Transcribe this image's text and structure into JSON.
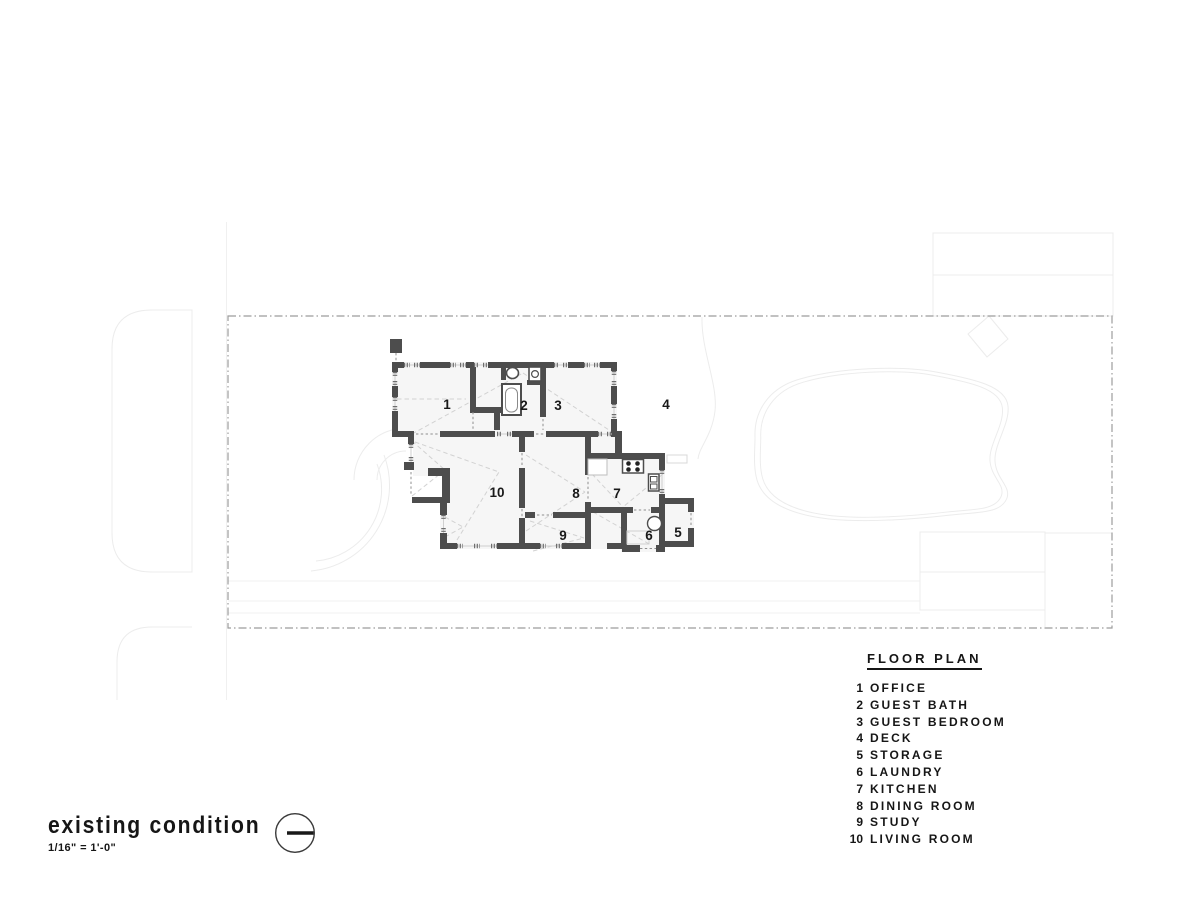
{
  "title_block": {
    "title": "existing condition",
    "scale": "1/16\" = 1'-0\""
  },
  "legend": {
    "title": "FLOOR PLAN",
    "items": [
      {
        "num": "1",
        "label": "OFFICE"
      },
      {
        "num": "2",
        "label": "GUEST BATH"
      },
      {
        "num": "3",
        "label": "GUEST BEDROOM"
      },
      {
        "num": "4",
        "label": "DECK"
      },
      {
        "num": "5",
        "label": "STORAGE"
      },
      {
        "num": "6",
        "label": "LAUNDRY"
      },
      {
        "num": "7",
        "label": "KITCHEN"
      },
      {
        "num": "8",
        "label": "DINING ROOM"
      },
      {
        "num": "9",
        "label": "STUDY"
      },
      {
        "num": "10",
        "label": "LIVING ROOM"
      }
    ]
  },
  "plan": {
    "rooms": [
      {
        "number": "1",
        "name": "office"
      },
      {
        "number": "2",
        "name": "guest bath"
      },
      {
        "number": "3",
        "name": "guest bedroom"
      },
      {
        "number": "4",
        "name": "deck"
      },
      {
        "number": "10",
        "name": "living room"
      },
      {
        "number": "8",
        "name": "dining room"
      },
      {
        "number": "7",
        "name": "kitchen"
      },
      {
        "number": "9",
        "name": "study"
      },
      {
        "number": "6",
        "name": "laundry"
      },
      {
        "number": "5",
        "name": "storage"
      }
    ]
  },
  "colors": {
    "wall": "#4d4d4d",
    "room_fill": "#f6f6f6",
    "boundary_line": "#9c9c9c",
    "site_line": "#ececec",
    "text": "#161616"
  }
}
